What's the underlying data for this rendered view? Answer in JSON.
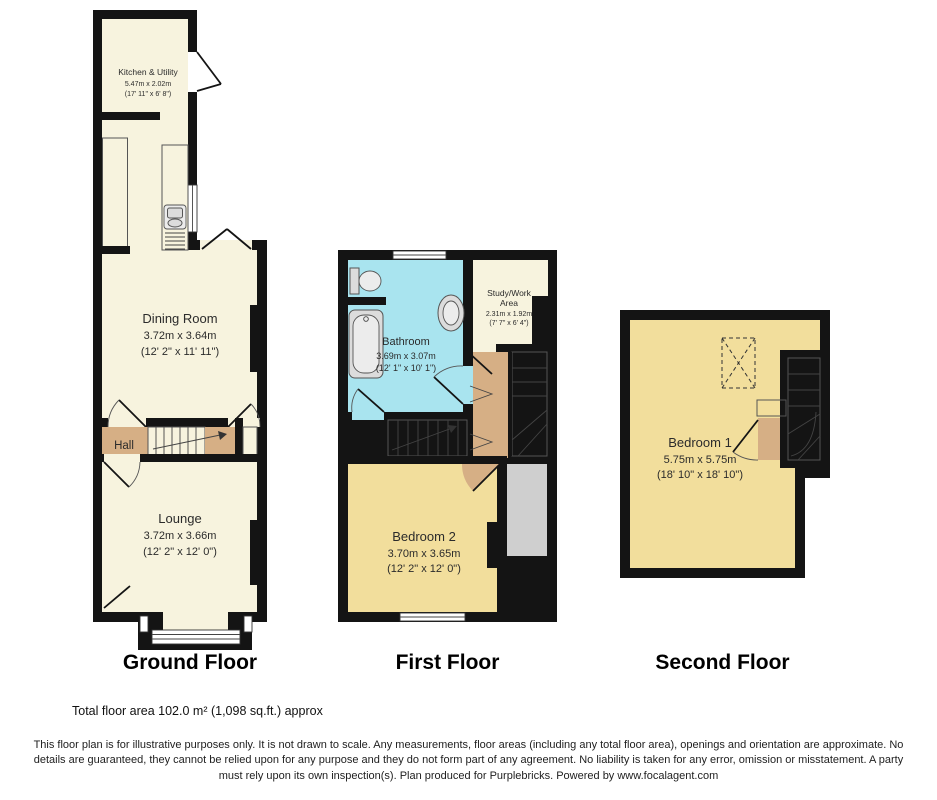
{
  "plans": {
    "ground": {
      "label": "Ground Floor",
      "rooms": {
        "kitchen": {
          "name": "Kitchen & Utility",
          "metric": "5.47m x 2.02m",
          "imperial": "(17' 11\" x 6' 8\")"
        },
        "dining": {
          "name": "Dining Room",
          "metric": "3.72m x 3.64m",
          "imperial": "(12' 2\" x 11' 11\")"
        },
        "hall": {
          "name": "Hall"
        },
        "lounge": {
          "name": "Lounge",
          "metric": "3.72m x 3.66m",
          "imperial": "(12' 2\" x 12' 0\")"
        }
      }
    },
    "first": {
      "label": "First Floor",
      "rooms": {
        "bathroom": {
          "name": "Bathroom",
          "metric": "3.69m x 3.07m",
          "imperial": "(12' 1\" x 10' 1\")"
        },
        "study": {
          "name_line1": "Study/Work",
          "name_line2": "Area",
          "metric": "2.31m x 1.92m",
          "imperial": "(7' 7\" x 6' 4\")"
        },
        "bedroom2": {
          "name": "Bedroom 2",
          "metric": "3.70m x 3.65m",
          "imperial": "(12' 2\" x 12' 0\")"
        }
      }
    },
    "second": {
      "label": "Second Floor",
      "rooms": {
        "bedroom1": {
          "name": "Bedroom 1",
          "metric": "5.75m x 5.75m",
          "imperial": "(18' 10\" x 18' 10\")"
        }
      }
    }
  },
  "footer": {
    "total_area": "Total floor area 102.0 m² (1,098 sq.ft.) approx",
    "disclaimer": "This floor plan is for illustrative purposes only. It is not drawn to scale. Any measurements, floor areas (including any total floor area), openings and orientation are approximate. No details are guaranteed, they cannot be relied upon for any purpose and they do not form part of any agreement. No liability is taken for any error, omission or misstatement. A party must rely upon its own inspection(s). Plan produced for Purplebricks. Powered by www.focalagent.com"
  },
  "colors": {
    "wall": "#141414",
    "room_cream": "#F7F3DE",
    "room_yellow": "#F2DE9C",
    "room_blue": "#A9E4EF",
    "hall_tan": "#D6AF85",
    "stairs_gray": "#C4C4C4",
    "cupboard_gray": "#CFCFCF"
  }
}
